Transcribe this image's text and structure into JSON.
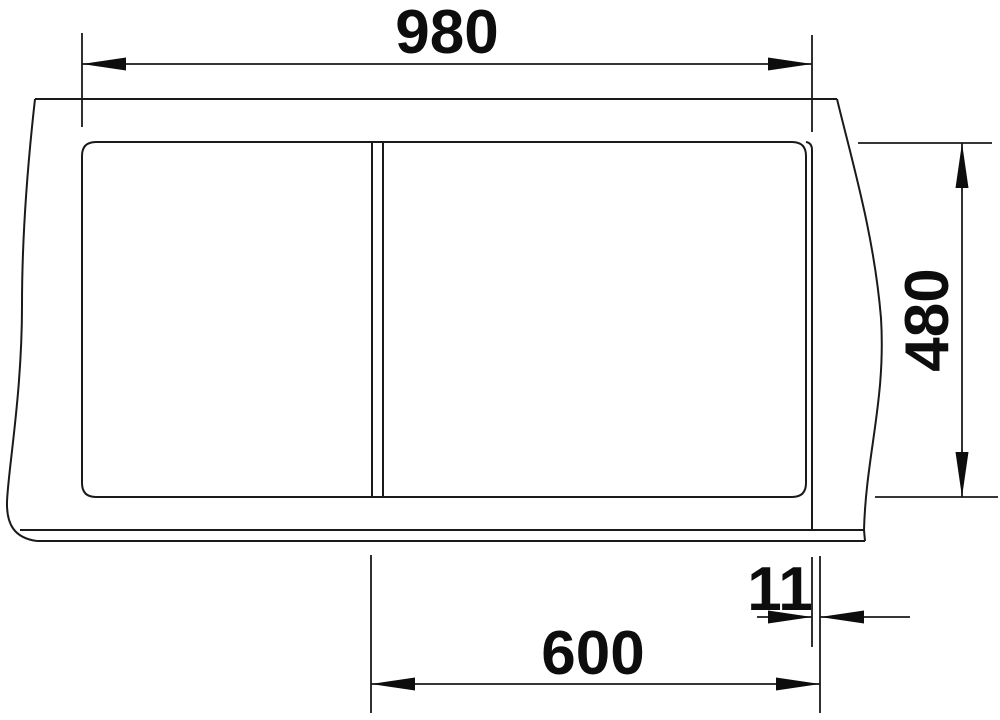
{
  "drawing": {
    "background_color": "#ffffff",
    "line_color": "#1a1a1a",
    "text_color": "#0d0d0d",
    "dimensions": {
      "overall_width_mm": "980",
      "overall_depth_mm": "480",
      "cabinet_width_mm": "600",
      "edge_offset_mm": "11"
    }
  }
}
